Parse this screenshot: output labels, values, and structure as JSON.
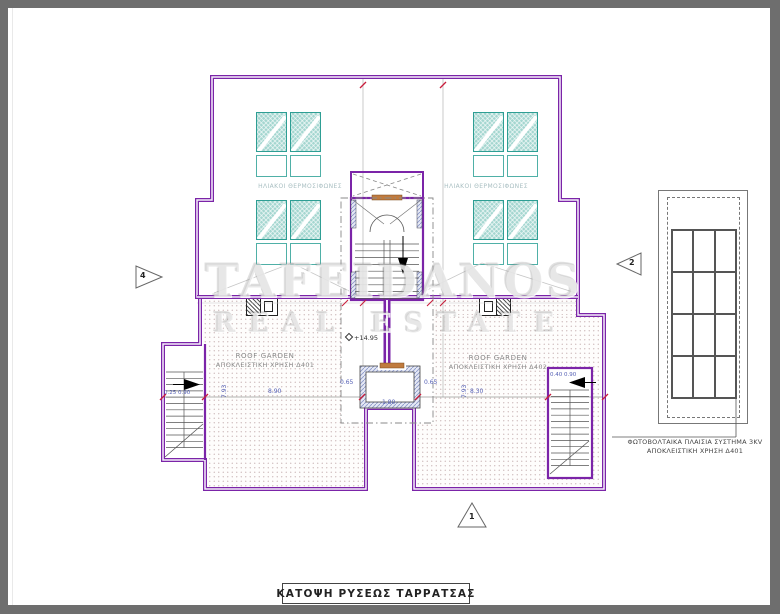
{
  "title": "ΚΑΤΟΨΗ ΡΥΣΕΩΣ ΤΑΡΡΑΤΣΑΣ",
  "watermark": {
    "line1": "TAFEIDANOS",
    "line2": "REAL ESTATE"
  },
  "annotations": {
    "solar_label_left": "ΗΛΙΑΚΟΙ ΘΕΡΜΟΣΙΦΩΝΕΣ",
    "solar_label_right": "ΗΛΙΑΚΟΙ ΘΕΡΜΟΣΙΦΩΝΕΣ",
    "roof_garden_left": {
      "line1": "ROOF GARDEN",
      "line2": "ΑΠΟΚΛΕΙΣΤΙΚΗ ΧΡΗΣΗ Δ401"
    },
    "roof_garden_right": {
      "line1": "ROOF GARDEN",
      "line2": "ΑΠΟΚΛΕΙΣΤΙΚΗ ΧΡΗΣΗ Δ402"
    },
    "photovoltaic": {
      "line1": "ΦΩΤΟΒΟΛΤΑΙΚΑ ΠΛΑΙΣΙΑ ΣΥΣΤΗΜΑ 3KV",
      "line2": "ΑΠΟΚΛΕΙΣΤΙΚΗ ΧΡΗΣΗ Δ401"
    },
    "level": "+14.95"
  },
  "dimensions": {
    "left_garden_width": "8.90",
    "right_garden_width": "8.30",
    "shaft_width": "1.80",
    "shaft_wall_left": "0.65",
    "shaft_wall_right": "0.65",
    "left_stair": "0.25  0.90",
    "right_stair": "0.40  0.90",
    "left_garden_height": "7.93",
    "right_garden_height": "7.93"
  },
  "markers": {
    "bottom": "1",
    "right": "2",
    "left": "4"
  },
  "colors": {
    "wall": "#7b24a8",
    "solar_panel": "#a4d6d0",
    "solar_border": "#2e9e94",
    "dimension_tick": "#c81e3c",
    "dimension_text": "#5560b5",
    "frame": "#6e6e6e"
  }
}
